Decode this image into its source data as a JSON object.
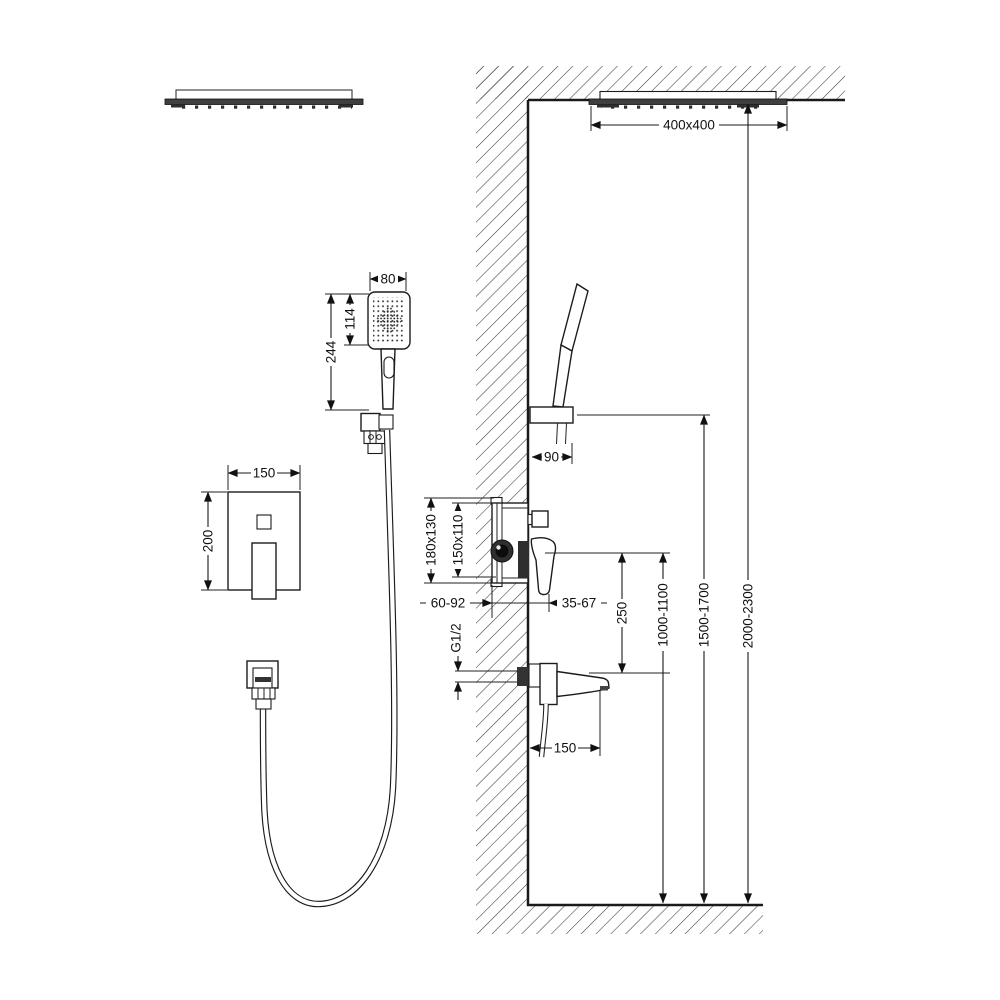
{
  "diagram": {
    "type": "shower-system-installation-drawing",
    "colors": {
      "line": "#1c1c1c",
      "dark_fill": "#3f3f3f",
      "background": "#ffffff"
    },
    "dimensions": {
      "rain_head_size": "400x400",
      "rain_head_height_range": "2000-2300",
      "holder_height_range": "1500-1700",
      "mixer_height_range": "1000-1100",
      "mixer_to_spout": "250",
      "hand_shower_width": "80",
      "hand_shower_head_length": "114",
      "hand_shower_total_length": "244",
      "trim_plate_width": "150",
      "trim_plate_height": "200",
      "holder_offset": "90",
      "valve_outer_size": "180x130",
      "valve_inner_size": "150x110",
      "embed_depth_range": "60-92",
      "protrusion_range": "35-67",
      "spout_length": "150",
      "thread_size": "G1/2"
    }
  }
}
